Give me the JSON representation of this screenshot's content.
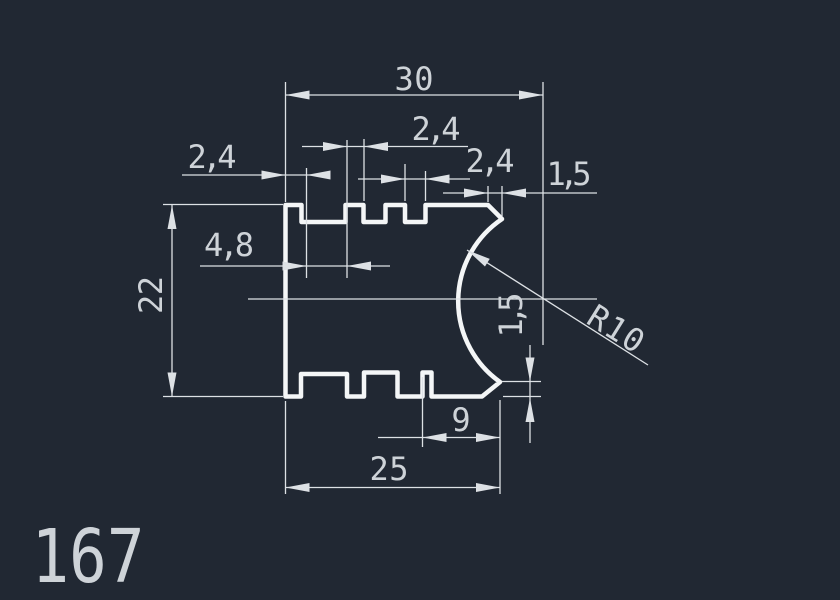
{
  "part_number": "167",
  "colors": {
    "background": "#212833",
    "outline": "#f4f6f7",
    "dimension": "#dde1e5",
    "text": "#ced3d8"
  },
  "dimensions": {
    "overall_width": "30",
    "left_tab_width": "2,4",
    "tooth_width": "2,4",
    "notch_width": "2,4",
    "top_chamfer_width": "1,5",
    "slot_width": "4,8",
    "overall_height": "22",
    "arc_radius": "R10",
    "right_chamfer_height": "1,5",
    "bottom_notch_offset": "9",
    "bottom_width": "25"
  }
}
